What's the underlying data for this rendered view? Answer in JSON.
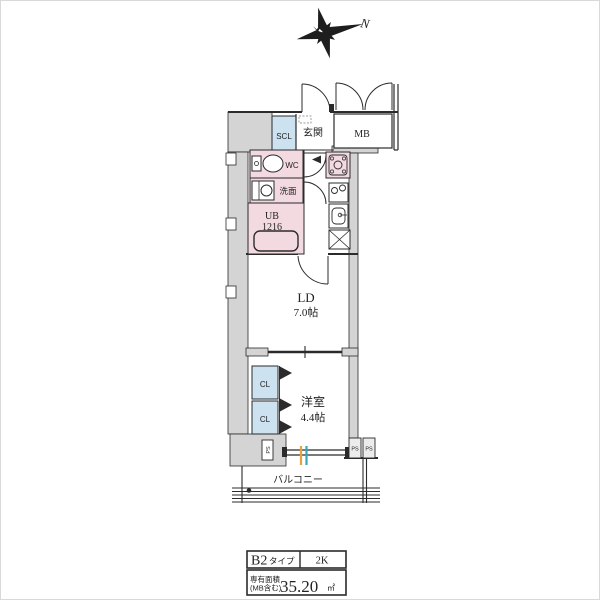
{
  "colors": {
    "wall_fill": "#d4d4d4",
    "wet_area_pink": "#f3dae1",
    "closet_blue": "#cde2f1",
    "line": "#2b2b2b",
    "window_mark_orange": "#e8a13c",
    "window_mark_teal": "#3aa6b9"
  },
  "compass": {
    "north_label": "N"
  },
  "plan": {
    "entrance": {
      "shoe_closet": "SCL",
      "hall": "玄関",
      "meter_box": "MB"
    },
    "sanitary": {
      "toilet": "WC",
      "washroom": "洗面",
      "bath_name": "UB",
      "bath_size": "1216"
    },
    "living_dining": {
      "name": "LD",
      "size": "7.0帖"
    },
    "bedroom": {
      "name": "洋室",
      "size": "4.4帖",
      "closet_upper": "CL",
      "closet_lower": "CL"
    },
    "balcony": {
      "label": "バルコニー"
    },
    "pipe_spaces": [
      "PS",
      "PS",
      "PS"
    ]
  },
  "summary_table": {
    "type_name": "B2",
    "type_suffix": "タイプ",
    "layout": "2K",
    "area_label_line1": "専有面積",
    "area_label_line2": "(MB含む)",
    "area_value": "35.20",
    "area_unit": "㎡"
  }
}
